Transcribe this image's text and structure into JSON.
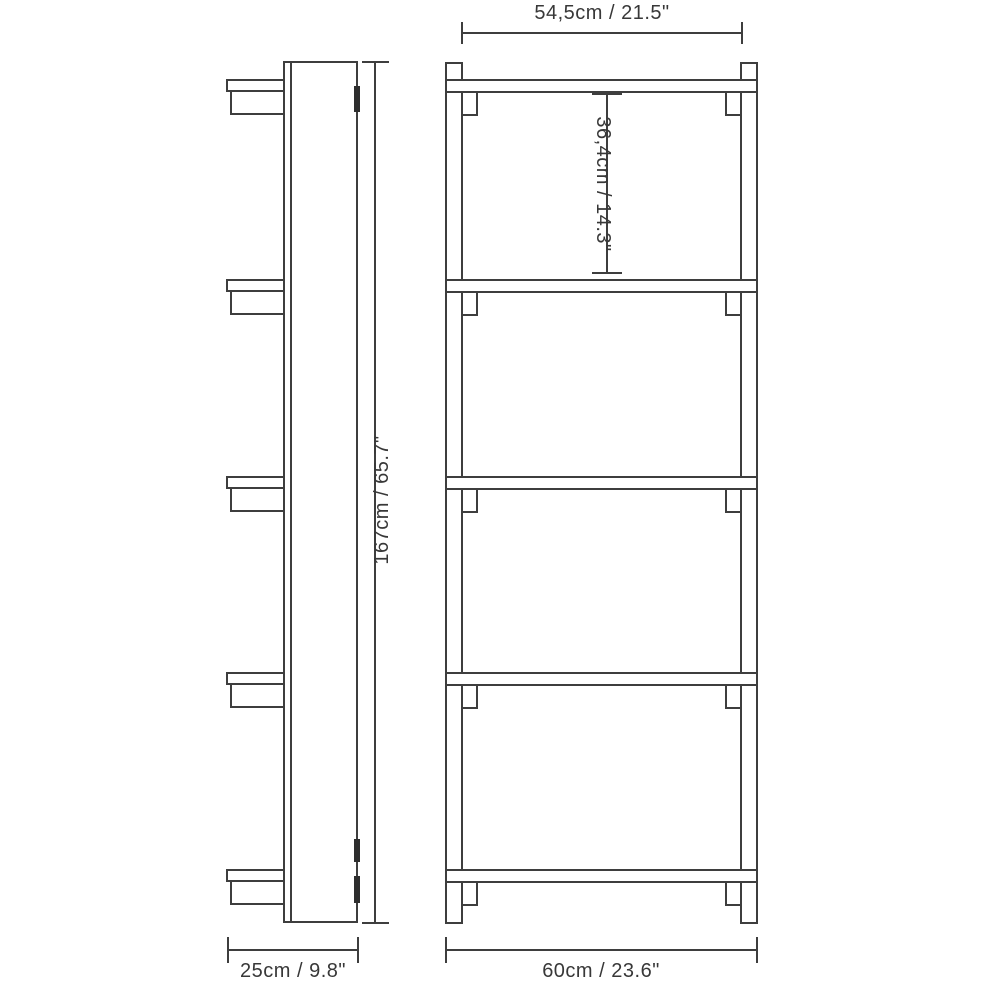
{
  "drawing": {
    "colors": {
      "background": "#ffffff",
      "line": "#3e3e3e",
      "text": "#383838",
      "mount_mark": "#2e2e2e"
    },
    "structure": {
      "shelf_count": 5,
      "bay_count": 4
    },
    "dimensions": {
      "top_width": "54,5cm / 21.5\"",
      "bay_height": "36,4cm / 14.3\"",
      "total_height": "167cm / 65.7\"",
      "depth": "25cm / 9.8\"",
      "total_width": "60cm / 23.6\""
    }
  }
}
